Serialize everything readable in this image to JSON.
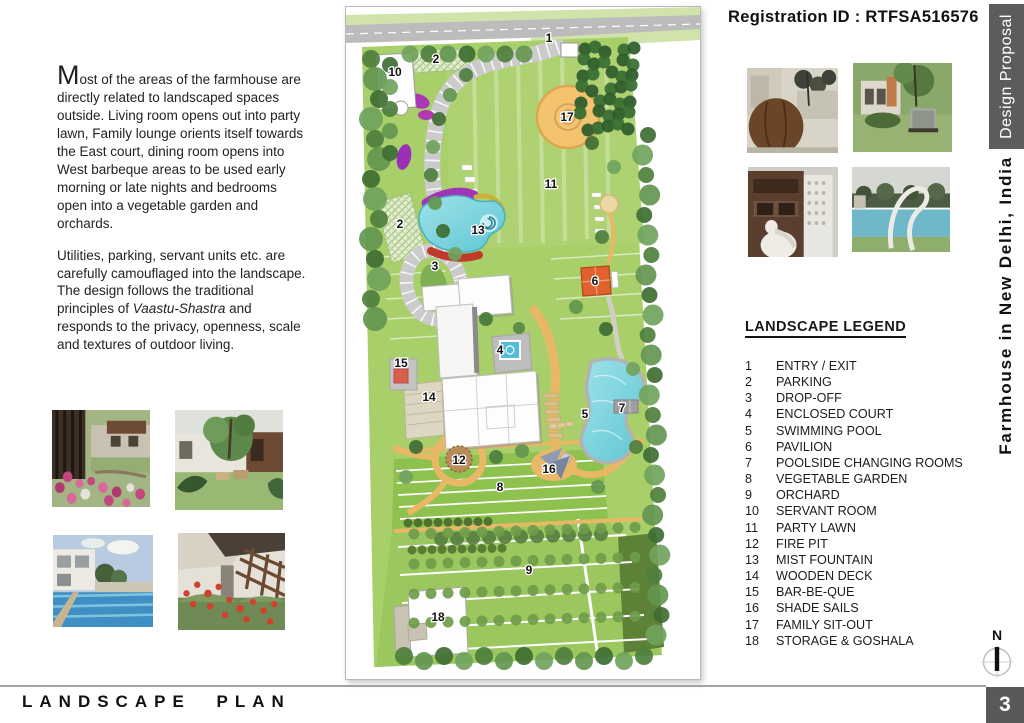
{
  "header": {
    "registration_label": "Registration ID : RTFSA516576"
  },
  "sidebar": {
    "tab_label": "Design Proposal",
    "project_title": "Farmhouse in New Delhi, India"
  },
  "intro": {
    "paragraph1": "Most of the areas of the farmhouse are directly related to landscaped spaces outside. Living room opens out into party lawn, Family lounge orients itself towards the East court, dining room opens into West barbeque areas to be used early morning or late nights and bedrooms open into a vegetable garden and orchards.",
    "paragraph2_pre": "Utilities, parking, servant units etc. are carefully camouflaged into the landscape. The design follows the traditional principles of ",
    "paragraph2_italic": "Vaastu-Shastra",
    "paragraph2_post": " and responds to the privacy, openness, scale and textures of outdoor living."
  },
  "legend": {
    "title": "LANDSCAPE LEGEND",
    "items": [
      {
        "num": "1",
        "label": "ENTRY / EXIT"
      },
      {
        "num": "2",
        "label": "PARKING"
      },
      {
        "num": "3",
        "label": "DROP-OFF"
      },
      {
        "num": "4",
        "label": "ENCLOSED COURT"
      },
      {
        "num": "5",
        "label": "SWIMMING POOL"
      },
      {
        "num": "6",
        "label": "PAVILION"
      },
      {
        "num": "7",
        "label": "POOLSIDE CHANGING ROOMS"
      },
      {
        "num": "8",
        "label": "VEGETABLE GARDEN"
      },
      {
        "num": "9",
        "label": "ORCHARD"
      },
      {
        "num": "10",
        "label": "SERVANT ROOM"
      },
      {
        "num": "11",
        "label": "PARTY LAWN"
      },
      {
        "num": "12",
        "label": "FIRE PIT"
      },
      {
        "num": "13",
        "label": "MIST FOUNTAIN"
      },
      {
        "num": "14",
        "label": "WOODEN DECK"
      },
      {
        "num": "15",
        "label": "BAR-BE-QUE"
      },
      {
        "num": "16",
        "label": "SHADE SAILS"
      },
      {
        "num": "17",
        "label": "FAMILY SIT-OUT"
      },
      {
        "num": "18",
        "label": "STORAGE & GOSHALA"
      }
    ]
  },
  "plan": {
    "markers": [
      {
        "num": "1",
        "x": 203,
        "y": 31
      },
      {
        "num": "2",
        "x": 90,
        "y": 52
      },
      {
        "num": "10",
        "x": 49,
        "y": 65
      },
      {
        "num": "17",
        "x": 221,
        "y": 110
      },
      {
        "num": "11",
        "x": 205,
        "y": 177
      },
      {
        "num": "2",
        "x": 54,
        "y": 217
      },
      {
        "num": "13",
        "x": 132,
        "y": 223
      },
      {
        "num": "3",
        "x": 89,
        "y": 259
      },
      {
        "num": "6",
        "x": 249,
        "y": 274
      },
      {
        "num": "4",
        "x": 154,
        "y": 343
      },
      {
        "num": "15",
        "x": 55,
        "y": 356
      },
      {
        "num": "14",
        "x": 83,
        "y": 390
      },
      {
        "num": "7",
        "x": 276,
        "y": 401
      },
      {
        "num": "5",
        "x": 239,
        "y": 407
      },
      {
        "num": "12",
        "x": 113,
        "y": 453
      },
      {
        "num": "16",
        "x": 203,
        "y": 462
      },
      {
        "num": "8",
        "x": 154,
        "y": 480
      },
      {
        "num": "9",
        "x": 183,
        "y": 563
      },
      {
        "num": "18",
        "x": 92,
        "y": 610
      }
    ]
  },
  "photos": {
    "top_right": [
      "sphere-sculpture-court",
      "garden-lounge-chair",
      "jali-facade-sculpture",
      "pool-arc-sculpture"
    ],
    "bottom_left": [
      "wood-screen-flower-bed",
      "lawn-tree-sitout",
      "swimming-pool-villa",
      "poppy-garden-pergola"
    ]
  },
  "footer": {
    "title": "LANDSCAPE PLAN",
    "page_number": "3",
    "north_label": "N"
  },
  "colors": {
    "accent_dark": "#58595B",
    "path_orange": "#e8b866",
    "water": "#6fd1dc"
  }
}
